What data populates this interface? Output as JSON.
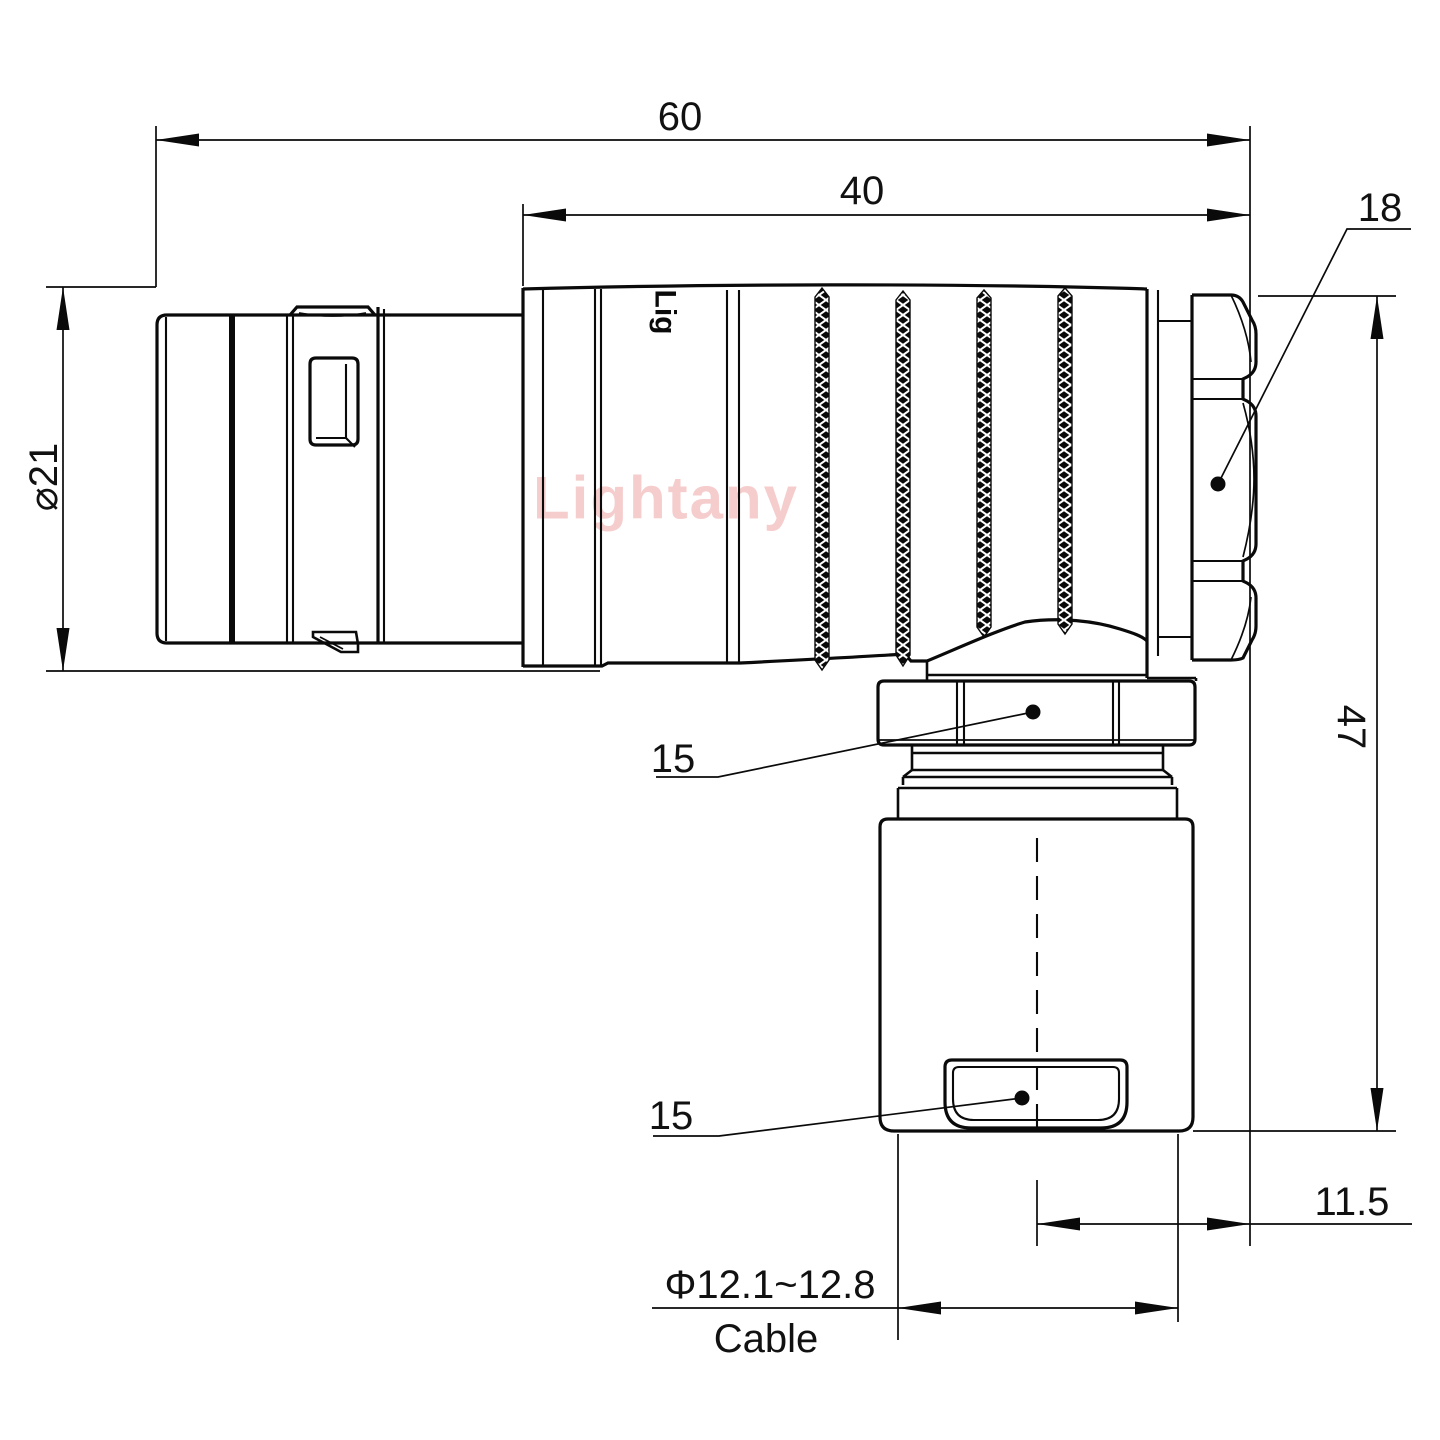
{
  "drawing": {
    "kind": "connector-technical-drawing",
    "background": "#ffffff",
    "line_color": "#0a0a0a"
  },
  "watermark": {
    "text": "Lightany",
    "color": "#f6cdcd"
  },
  "body_logo": {
    "text": "Lig"
  },
  "dims": {
    "overall_length": "60",
    "front_length": "40",
    "backnut_width": "18",
    "shell_diameter": "⌀21",
    "overall_height": "47",
    "coupling_nut_width": "15",
    "clamp_width": "15",
    "exit_offset": "11.5",
    "cable_diameter": "Φ12.1~12.8",
    "cable_label": "Cable"
  }
}
